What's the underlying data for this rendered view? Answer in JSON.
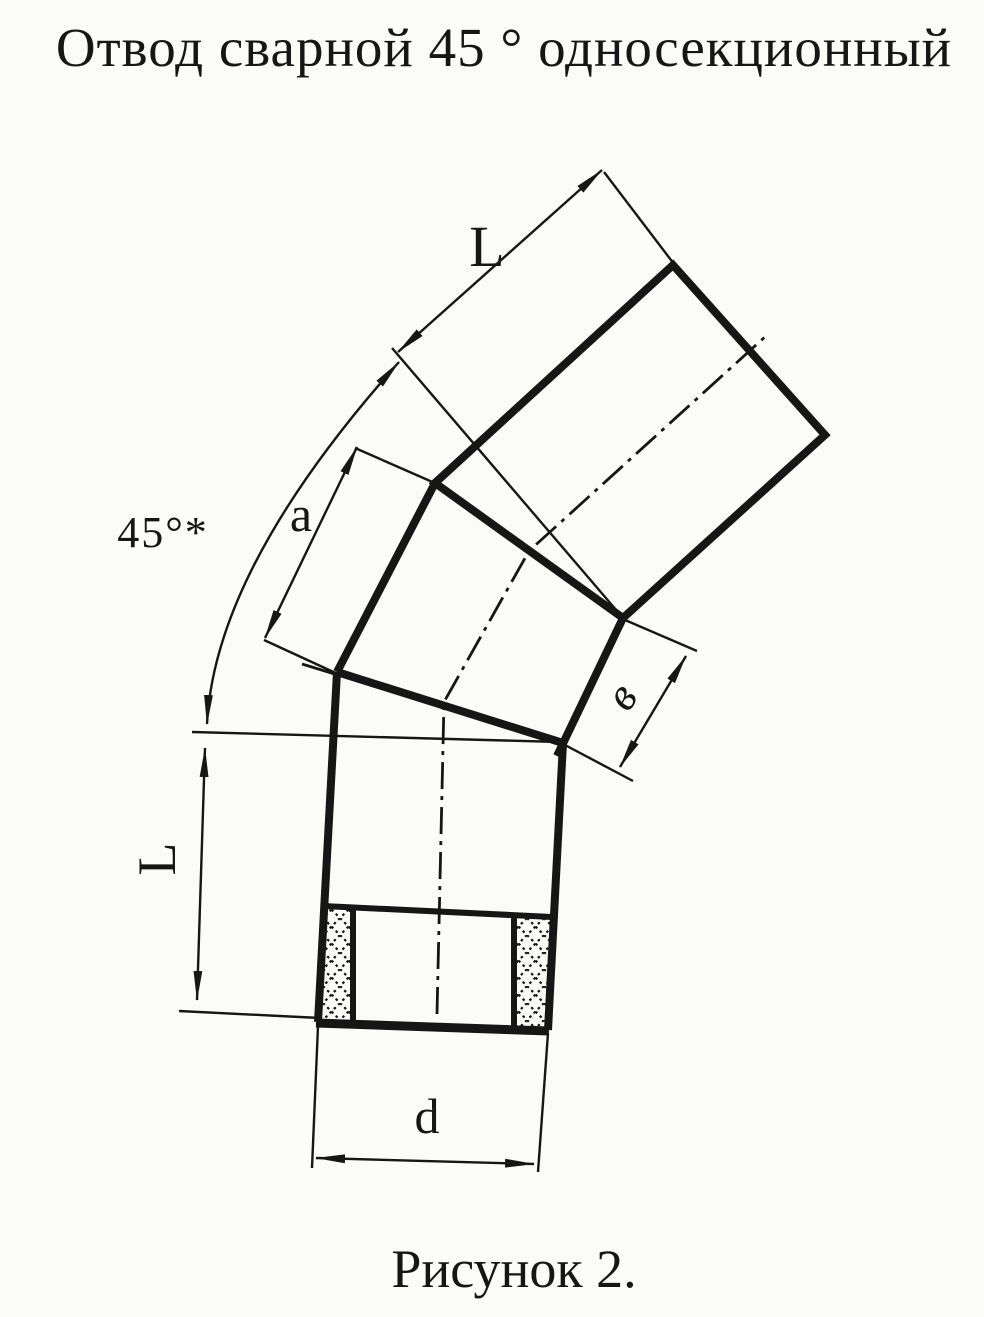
{
  "page": {
    "title": "Отвод сварной 45 ° односекционный",
    "caption": "Рисунок 2."
  },
  "drawing": {
    "labels": {
      "top_length": "L",
      "middle_section_length": "a",
      "bend_angle": "45°*",
      "end_face_width": "в",
      "bottom_length": "L",
      "diameter": "d"
    }
  },
  "colors": {
    "ink": "#161616",
    "paper": "#fbfbf8"
  }
}
